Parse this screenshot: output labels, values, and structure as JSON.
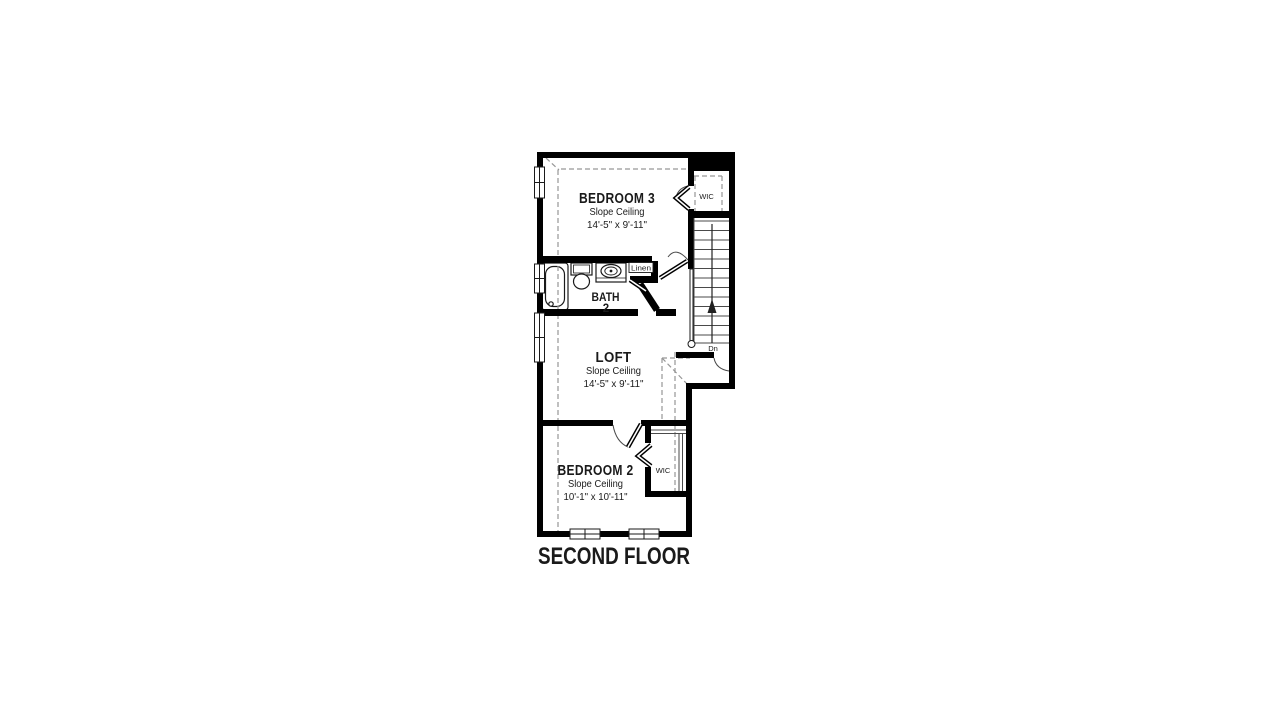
{
  "title": "SECOND FLOOR",
  "colors": {
    "walls": "#000000",
    "background": "#ffffff",
    "dashed_lines": "#969696"
  },
  "rooms": {
    "bedroom3": {
      "name": "BEDROOM 3",
      "ceiling": "Slope Ceiling",
      "dimensions": "14'-5\" x 9'-11\""
    },
    "bath2": {
      "line1": "BATH",
      "line2": "2"
    },
    "loft": {
      "name": "LOFT",
      "ceiling": "Slope Ceiling",
      "dimensions": "14'-5\" x 9'-11\""
    },
    "bedroom2": {
      "name": "BEDROOM 2",
      "ceiling": "Slope Ceiling",
      "dimensions": "10'-1\" x 10'-11\""
    },
    "wic_upper": {
      "name": "WIC"
    },
    "wic_lower": {
      "name": "WIC"
    },
    "linen": {
      "name": "Linen"
    }
  },
  "stairs": {
    "label": "Dn",
    "treads": 13
  }
}
